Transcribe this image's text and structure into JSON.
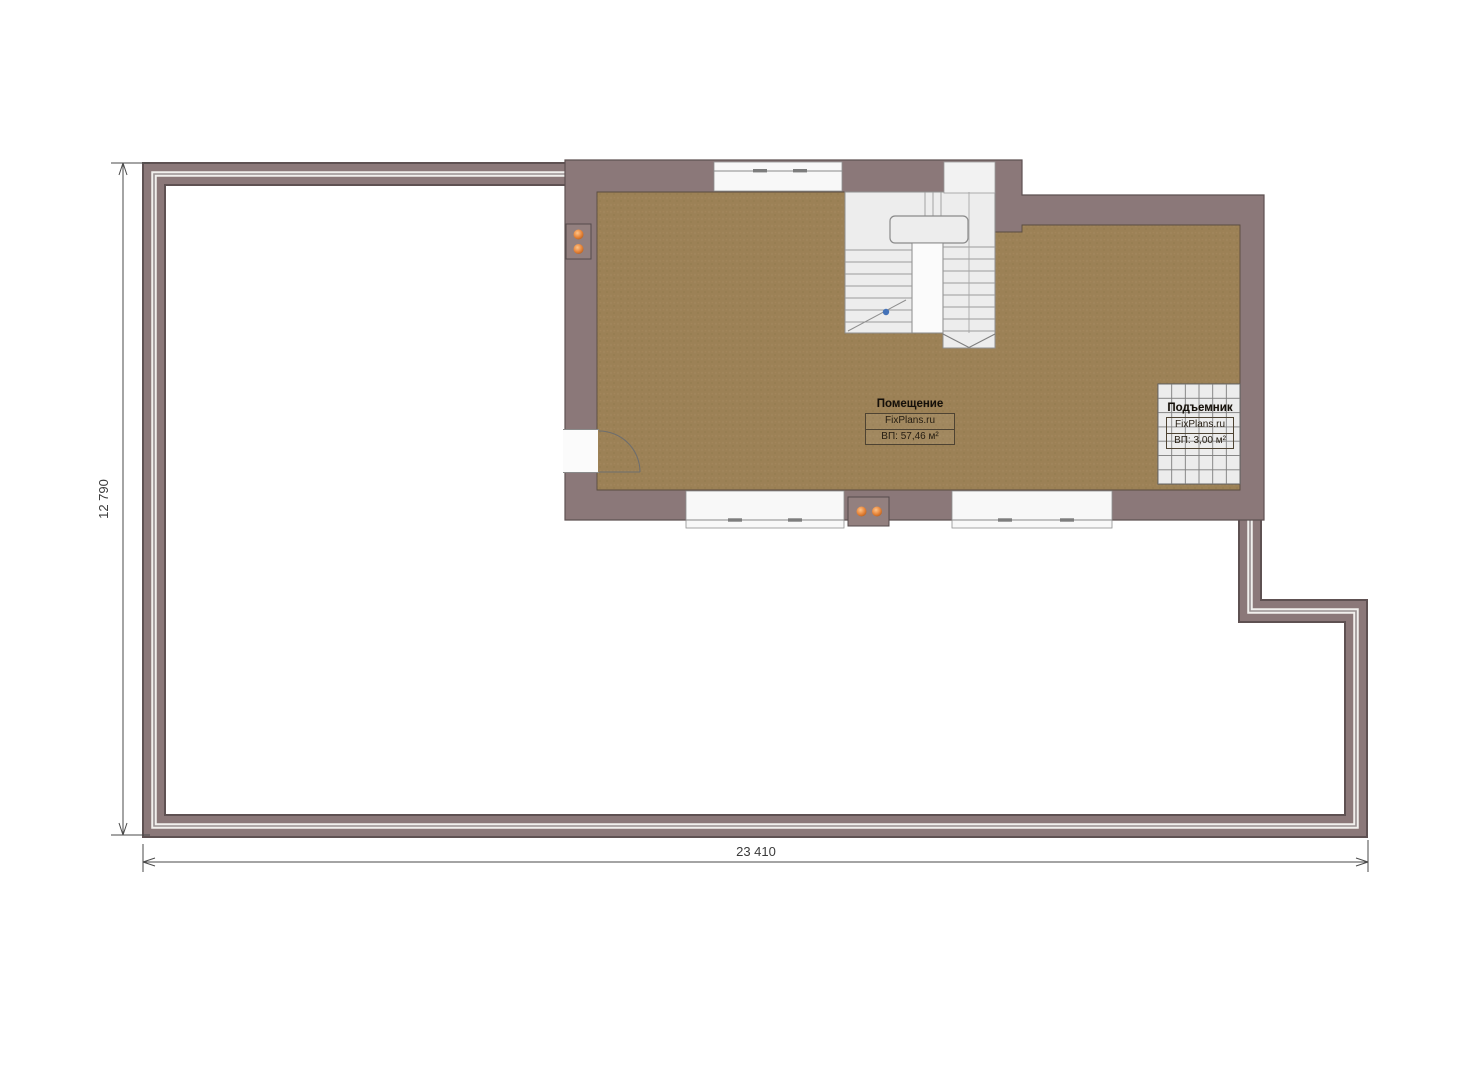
{
  "room": {
    "title": "Помещение",
    "brand": "FixPlans.ru",
    "area": "ВП: 57,46 м²"
  },
  "lift": {
    "title": "Подъемник",
    "brand": "FixPlans.ru",
    "area": "ВП: 3,00 м²"
  },
  "dimensions": {
    "width_label": "23 410",
    "height_label": "12 790"
  },
  "colors": {
    "wall": "#8b7879",
    "wall_outline": "#5e5152",
    "railing_light": "#f1efed",
    "railing_gray": "#999091",
    "floor": "#9c8156",
    "stair_fill": "#ededed",
    "lift_fill": "#ececec",
    "outlet_orange": "#e8873c",
    "marker_blue": "#4472b8",
    "dimension_line": "#4a4a4a"
  }
}
